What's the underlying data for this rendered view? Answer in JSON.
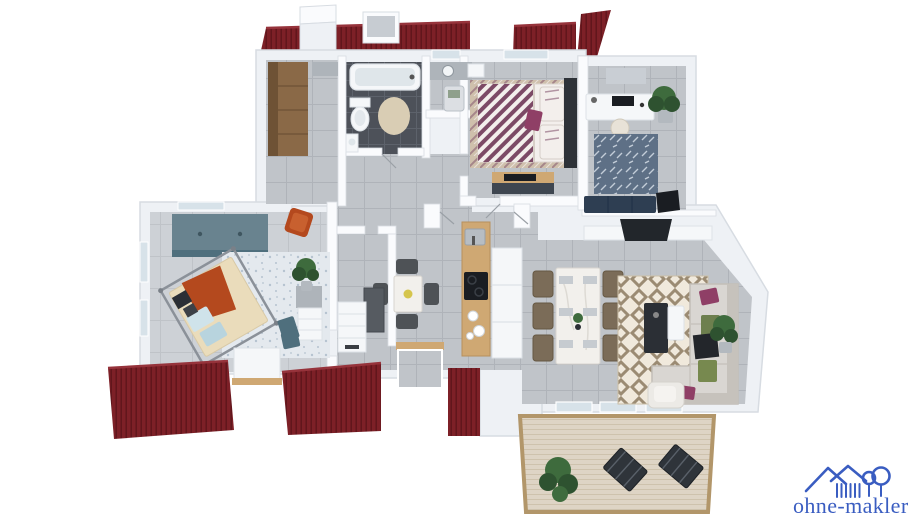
{
  "watermark": {
    "brand": "ohne-makler",
    "icon": "house-and-tree-icon",
    "color": "#3a5dc1"
  },
  "scene": {
    "type": "3d-floor-plan-render",
    "rooms": [
      "entry-closet",
      "bathroom",
      "utility-room",
      "bedroom",
      "office",
      "hallway",
      "bedroom-2",
      "stair-room",
      "kitchen",
      "living-dining-room",
      "terrace"
    ]
  },
  "colors": {
    "background": "#ffffff",
    "logo_blue": "#3a5dc1",
    "roof": "#7d2027",
    "roof_line": "#5e141b",
    "roof_lip": "#96333b",
    "wall": "#eef1f5",
    "wall_edge": "#d7dce2",
    "wall_white": "#fafbfd",
    "floor": "#c0c4c9",
    "floor_line": "#afb3b9",
    "floor_light": "#cdd1d6",
    "floor_light_line": "#bfc3c8",
    "floor_dark": "#4d5159",
    "floor_dark_line": "#5d626b",
    "glass": "#d7e2e9",
    "wood": "#8a6947",
    "wood_dark": "#6e5235",
    "counter_wood": "#cfa873",
    "counter_wood_edge": "#b7905c",
    "deck": "#ded4c5",
    "deck_line": "#cec2ad",
    "deck_frame": "#b2966a",
    "teal": "#69838f",
    "teal_dark": "#4f6f7d",
    "rug_left": "#e4e9ee",
    "rug_left_dot": "#b6c3d0",
    "rug_bed": "#cfc0ac",
    "rug_bed_accent": "#7c4a66",
    "bed_white": "#f3efec",
    "bed_purple": "#7c4a66",
    "headboard": "#2e3238",
    "orange": "#b4491e",
    "orange_light": "#c8602f",
    "bed_beige": "#eadcbb",
    "pillow_blue": "#cfe3ea",
    "pillow_blue2": "#b8d4de",
    "rug_blue": "#5e7086",
    "rug_blue_fleck": "#c3cdd8",
    "navy": "#2e3e52",
    "navy_line": "#243449",
    "rug_living_bg": "#f0e9dc",
    "rug_living_fg": "#9b8b73",
    "sofa": "#d9d6d2",
    "sofa_dark": "#c6c2bc",
    "sofa_edge": "#c2beb8",
    "pillow_green": "#6d7f4e",
    "pillow_green2": "#77894f",
    "pillow_magenta": "#8f3f66",
    "throw_dark": "#23262b",
    "chair_brown": "#7b6c58",
    "chair_brown_edge": "#665944",
    "chair_dark": "#4e5256",
    "table_white": "#f2f0ec",
    "table_edge": "#d8d5cf",
    "black": "#1a1d22",
    "gray_furn": "#aeb4ba",
    "dark_cab": "#565b61",
    "white_furn": "#f5f7f9",
    "white_furn_edge": "#dde2e7",
    "plant": "#3e6b3d",
    "plant_dark": "#2e5230",
    "pot": "#b3b9bf",
    "beige_rug": "#d9cdb4",
    "mat_gray": "#c9ced4",
    "lounger": "#2f343a",
    "lounger_slat": "#596069",
    "chair_cream": "#e8e2d7"
  }
}
